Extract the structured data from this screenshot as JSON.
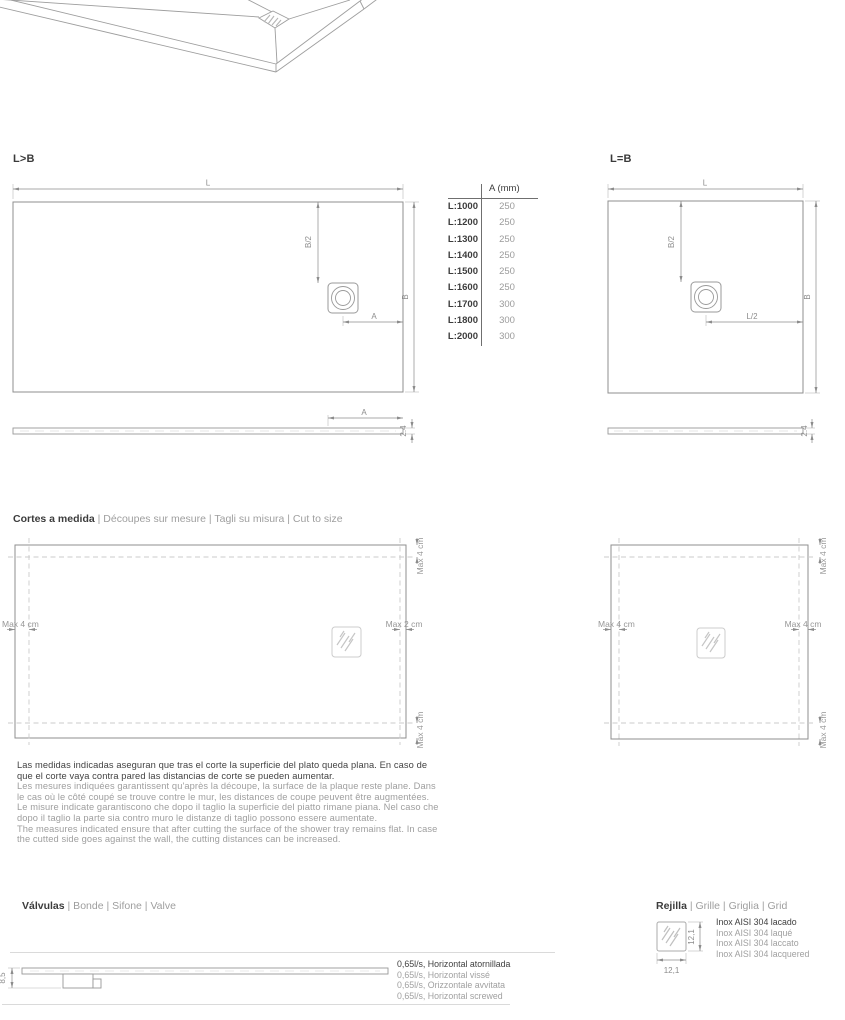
{
  "diagrams": {
    "left": {
      "title": "L>B",
      "dim_L": "L",
      "dim_B": "B",
      "dim_B2": "B/2",
      "dim_A": "A"
    },
    "right": {
      "title": "L=B",
      "dim_L": "L",
      "dim_B": "B",
      "dim_B2": "B/2",
      "dim_L2": "L/2"
    },
    "profile": {
      "dim_A": "A",
      "thickness": "2.4"
    }
  },
  "table": {
    "header": "A (mm)",
    "rows": [
      {
        "model": "L:1000",
        "value": "250"
      },
      {
        "model": "L:1200",
        "value": "250"
      },
      {
        "model": "L:1300",
        "value": "250"
      },
      {
        "model": "L:1400",
        "value": "250"
      },
      {
        "model": "L:1500",
        "value": "250"
      },
      {
        "model": "L:1600",
        "value": "250"
      },
      {
        "model": "L:1700",
        "value": "300"
      },
      {
        "model": "L:1800",
        "value": "300"
      },
      {
        "model": "L:2000",
        "value": "300"
      }
    ]
  },
  "cut": {
    "title_primary": "Cortes a medida",
    "title_rest": " | Découpes sur mesure | Tagli su misura | Cut to size",
    "max4": "Max 4 cm",
    "max2": "Max 2 cm",
    "notes": [
      "Las medidas indicadas aseguran que tras el corte la superficie del plato queda plana. En caso de",
      "que el corte vaya contra pared las distancias de corte se pueden aumentar.",
      "Les mesures indiquées garantissent qu'après la découpe, la surface de la plaque reste plane. Dans",
      "le cas où le côté coupé se trouve contre le mur, les distances de coupe peuvent être augmentées.",
      "Le misure indicate garantiscono che dopo il taglio la superficie del piatto rimane piana. Nel caso che",
      "dopo il taglio la parte sia contro muro le distanze di taglio possono essere aumentate.",
      "The measures indicated ensure that after cutting the surface of the shower tray remains flat. In case",
      "the cutted side goes against the wall, the cutting distances can be increased."
    ]
  },
  "valves": {
    "title_primary": "Válvulas",
    "title_rest": " | Bonde | Sifone | Valve",
    "dim_height": "8,5",
    "specs": [
      "0,65l/s, Horizontal atornillada",
      "0,65l/s, Horizontal vissé",
      "0,65l/s, Orizzontale avvitata",
      "0,65l/s, Horizontal screwed"
    ]
  },
  "grid": {
    "title_primary": "Rejilla",
    "title_rest": " | Grille | Griglia | Grid",
    "dim_width": "12,1",
    "dim_height": "12,1",
    "specs": [
      "Inox AISI 304 lacado",
      "Inox AISI 304 laqué",
      "Inox AISI 304 laccato",
      "Inox AISI 304 lacquered"
    ]
  }
}
